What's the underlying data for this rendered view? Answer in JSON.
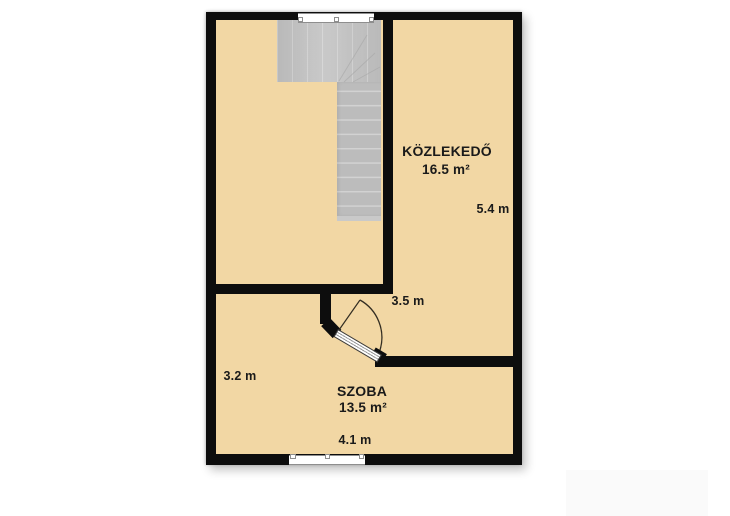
{
  "rooms": {
    "kozlekedo": {
      "name": "KÖZLEKEDŐ",
      "area": "16.5 m²"
    },
    "szoba": {
      "name": "SZOBA",
      "area": "13.5 m²"
    }
  },
  "dimensions": {
    "kozlekedo_side": "5.4 m",
    "kozlekedo_bottom": "3.5 m",
    "szoba_side": "3.2 m",
    "szoba_bottom": "4.1 m"
  },
  "colors": {
    "floor": "#F2D7A4",
    "wall": "#0D0D0D",
    "stair": "#BCBCBC",
    "stair-light": "#C4C4C4",
    "stair-line": "#D2D2D2",
    "window-frame": "#8E8E8E",
    "text": "#1A1A1A"
  }
}
